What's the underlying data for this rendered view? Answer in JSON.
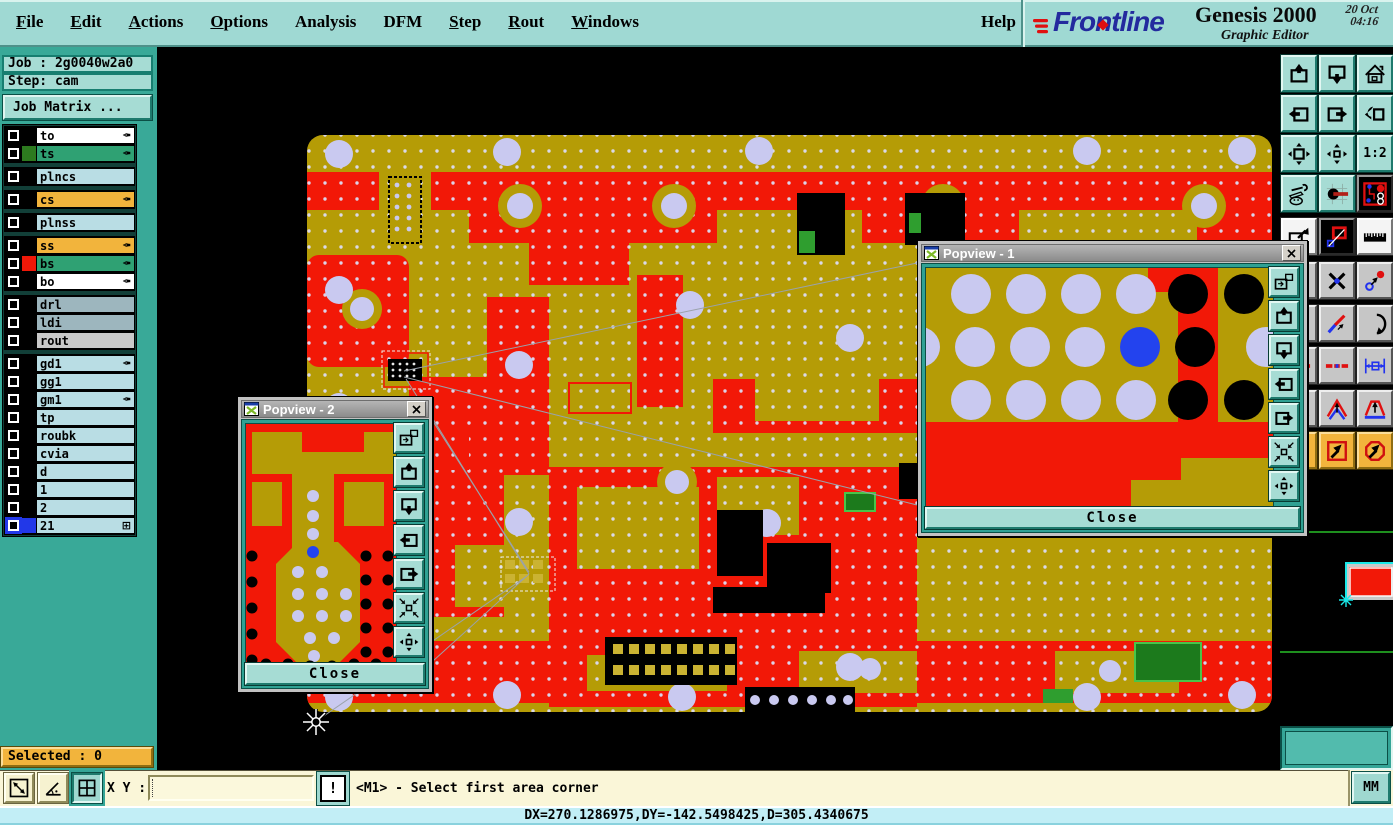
{
  "app": {
    "brand": "Frontline",
    "product": "Genesis 2000",
    "date": "20 Oct",
    "time": "04:16",
    "subtitle": "Graphic Editor"
  },
  "menu": {
    "items": [
      {
        "label": "File",
        "u": 0
      },
      {
        "label": "Edit",
        "u": 0
      },
      {
        "label": "Actions",
        "u": 0
      },
      {
        "label": "Options",
        "u": 0
      },
      {
        "label": "Analysis",
        "u": -1
      },
      {
        "label": "DFM",
        "u": -1
      },
      {
        "label": "Step",
        "u": 0
      },
      {
        "label": "Rout",
        "u": 0
      },
      {
        "label": "Windows",
        "u": 0
      }
    ],
    "help": "Help"
  },
  "sidebar": {
    "job": "Job : 2g0040w2a0",
    "step": "Step: cam",
    "job_matrix": "Job Matrix ...",
    "selected": "Selected : 0"
  },
  "layers": [
    {
      "name": "to",
      "field": "#FFFFFF",
      "swatch": "#000000",
      "icon": "pen",
      "gap_after": false,
      "selected": false
    },
    {
      "name": "ts",
      "field": "#2FA173",
      "swatch": "#2D7A1F",
      "icon": "pen",
      "gap_after": true,
      "selected": false
    },
    {
      "name": "plncs",
      "field": "#B9DDE4",
      "swatch": "#000000",
      "icon": null,
      "gap_after": true,
      "selected": false
    },
    {
      "name": "cs",
      "field": "#F2B43C",
      "swatch": "#000000",
      "icon": "pen",
      "gap_after": true,
      "selected": false
    },
    {
      "name": "plnss",
      "field": "#B9DDE4",
      "swatch": "#000000",
      "icon": null,
      "gap_after": true,
      "selected": false
    },
    {
      "name": "ss",
      "field": "#F2B43C",
      "swatch": "#000000",
      "icon": "pen",
      "gap_after": false,
      "selected": false
    },
    {
      "name": "bs",
      "field": "#2FA173",
      "swatch": "#F01808",
      "icon": "pen",
      "gap_after": false,
      "selected": false
    },
    {
      "name": "bo",
      "field": "#FFFFFF",
      "swatch": "#000000",
      "icon": "pen",
      "gap_after": true,
      "selected": false
    },
    {
      "name": "drl",
      "field": "#9DB6BE",
      "swatch": "#000000",
      "icon": null,
      "gap_after": false,
      "selected": false
    },
    {
      "name": "ldi",
      "field": "#9DB6BE",
      "swatch": "#000000",
      "icon": null,
      "gap_after": false,
      "selected": false
    },
    {
      "name": "rout",
      "field": "#C9C9C9",
      "swatch": "#000000",
      "icon": null,
      "gap_after": true,
      "selected": false
    },
    {
      "name": "gd1",
      "field": "#B9DDE4",
      "swatch": "#000000",
      "icon": "pen",
      "gap_after": false,
      "selected": false
    },
    {
      "name": "gg1",
      "field": "#B9DDE4",
      "swatch": "#000000",
      "icon": null,
      "gap_after": false,
      "selected": false
    },
    {
      "name": "gm1",
      "field": "#B9DDE4",
      "swatch": "#000000",
      "icon": "pen",
      "gap_after": false,
      "selected": false
    },
    {
      "name": "tp",
      "field": "#B9DDE4",
      "swatch": "#000000",
      "icon": null,
      "gap_after": false,
      "selected": false
    },
    {
      "name": "roubk",
      "field": "#B9DDE4",
      "swatch": "#000000",
      "icon": null,
      "gap_after": false,
      "selected": false
    },
    {
      "name": "cvia",
      "field": "#B9DDE4",
      "swatch": "#000000",
      "icon": null,
      "gap_after": false,
      "selected": false
    },
    {
      "name": "d",
      "field": "#B9DDE4",
      "swatch": "#000000",
      "icon": null,
      "gap_after": false,
      "selected": false
    },
    {
      "name": "1",
      "field": "#B9DDE4",
      "swatch": "#000000",
      "icon": null,
      "gap_after": false,
      "selected": false
    },
    {
      "name": "2",
      "field": "#B9DDE4",
      "swatch": "#000000",
      "icon": null,
      "gap_after": false,
      "selected": false
    },
    {
      "name": "21",
      "field": "#B9DDE4",
      "swatch": "#2238E8",
      "icon": "grid",
      "gap_after": false,
      "selected": true
    }
  ],
  "toolbar": {
    "ratio_label": "1:2",
    "rows": [
      [
        {
          "name": "zoom-window-in",
          "glyph": "win_up",
          "style": "teal"
        },
        {
          "name": "zoom-window-out",
          "glyph": "win_down",
          "style": "teal"
        },
        {
          "name": "home-view",
          "glyph": "home",
          "style": "teal"
        }
      ],
      [
        {
          "name": "scroll-view-left",
          "glyph": "pan_left",
          "style": "teal"
        },
        {
          "name": "scroll-view-right",
          "glyph": "pan_right",
          "style": "teal"
        },
        {
          "name": "previous-view",
          "glyph": "prev_view",
          "style": "teal"
        }
      ],
      [
        {
          "name": "zoom-fit-window",
          "glyph": "zoom_fit",
          "style": "teal"
        },
        {
          "name": "zoom-center-window",
          "glyph": "zoom_center",
          "style": "teal"
        },
        {
          "name": "zoom-ratio-1-2",
          "glyph": "one_two",
          "style": "teal"
        }
      ],
      [
        {
          "name": "editor-setup-tools",
          "glyph": "tools",
          "style": "teal"
        },
        {
          "name": "measure-knob",
          "glyph": "knob",
          "style": "teal"
        },
        {
          "name": "netlist-viewer",
          "glyph": "netlist",
          "style": "black"
        }
      ],
      [
        {
          "name": "flip-view",
          "glyph": "flip",
          "style": "white"
        },
        {
          "name": "compare-windows",
          "glyph": "compare",
          "style": "black"
        },
        {
          "name": "ruler-overlay",
          "glyph": "ruler",
          "style": "white"
        }
      ],
      [
        {
          "name": "covered-button-1",
          "glyph": "del_x",
          "style": "gray"
        },
        {
          "name": "delete-reference",
          "glyph": "del_x",
          "style": "gray"
        },
        {
          "name": "move-origin",
          "glyph": "move_origin",
          "style": "gray"
        }
      ],
      [
        {
          "name": "covered-button-2",
          "glyph": "slant",
          "style": "gray"
        },
        {
          "name": "add-sloped-line",
          "glyph": "slant",
          "style": "gray"
        },
        {
          "name": "add-arc",
          "glyph": "arc",
          "style": "gray"
        }
      ],
      [
        {
          "name": "covered-button-3",
          "glyph": "dashed",
          "style": "gray"
        },
        {
          "name": "change-trace",
          "glyph": "dashed",
          "style": "gray"
        },
        {
          "name": "pad-dimension",
          "glyph": "dimension",
          "style": "gray"
        }
      ],
      [
        {
          "name": "covered-button-4",
          "glyph": "dir_open",
          "style": "gray"
        },
        {
          "name": "direction-open",
          "glyph": "dir_open",
          "style": "gray"
        },
        {
          "name": "direction-closed",
          "glyph": "dir_closed",
          "style": "gray"
        }
      ],
      [
        {
          "name": "covered-button-5",
          "glyph": "sel_rect",
          "style": "orange"
        },
        {
          "name": "select-inside-rectangle",
          "glyph": "sel_rect",
          "style": "orange"
        },
        {
          "name": "select-inside-polygon",
          "glyph": "sel_poly",
          "style": "orange"
        }
      ]
    ]
  },
  "popview1": {
    "title": "Popview - 1",
    "close_label": "Close",
    "buttons": [
      {
        "name": "duplicate-view",
        "glyph": "pop_compare"
      },
      {
        "name": "view-up",
        "glyph": "win_up"
      },
      {
        "name": "view-down",
        "glyph": "win_down"
      },
      {
        "name": "view-left",
        "glyph": "pan_left"
      },
      {
        "name": "view-right",
        "glyph": "pan_right"
      },
      {
        "name": "zoom-fit-diagonal",
        "glyph": "fit_diag"
      },
      {
        "name": "zoom-fit-axis",
        "glyph": "zoom_center"
      }
    ]
  },
  "popview2": {
    "title": "Popview - 2",
    "close_label": "Close",
    "buttons": [
      {
        "name": "duplicate-view",
        "glyph": "pop_compare"
      },
      {
        "name": "view-up",
        "glyph": "win_up"
      },
      {
        "name": "view-down",
        "glyph": "win_down"
      },
      {
        "name": "view-left",
        "glyph": "pan_left"
      },
      {
        "name": "view-right",
        "glyph": "pan_right"
      },
      {
        "name": "zoom-fit-diagonal",
        "glyph": "fit_diag"
      },
      {
        "name": "zoom-fit-axis",
        "glyph": "zoom_center"
      }
    ]
  },
  "cmdbar": {
    "xy_label": "X Y :",
    "input_value": "",
    "alert_label": "!",
    "prompt": "<M1> - Select first area corner",
    "buttons": [
      {
        "name": "measure-distance",
        "glyph": "meas_dist",
        "pressed": false
      },
      {
        "name": "measure-angle",
        "glyph": "meas_angle",
        "pressed": false
      },
      {
        "name": "grid-window",
        "glyph": "win_grid",
        "pressed": true
      }
    ]
  },
  "readout": {
    "x": "X = -111.7227",
    "y": "Y = -481.6547",
    "units": "MM"
  },
  "delta_line": "DX=270.1286975,DY=-142.5498425,D=305.4340675",
  "colors": {
    "menu_bg": "#9FD9D3",
    "teal_bg": "#39A998",
    "teal_face": "#A6DCD4",
    "orange": "#F2B43C",
    "cream": "#FAF6D8",
    "cyan_strip": "#C2EEF6",
    "pcb_olive": "#B59C06",
    "pcb_red": "#F21807",
    "pcb_hole": "#C9C9F0",
    "pcb_green": "#2F9E2F",
    "select_blue": "#2238E8",
    "logo_blue": "#232A9E",
    "logo_red": "#E01010"
  }
}
